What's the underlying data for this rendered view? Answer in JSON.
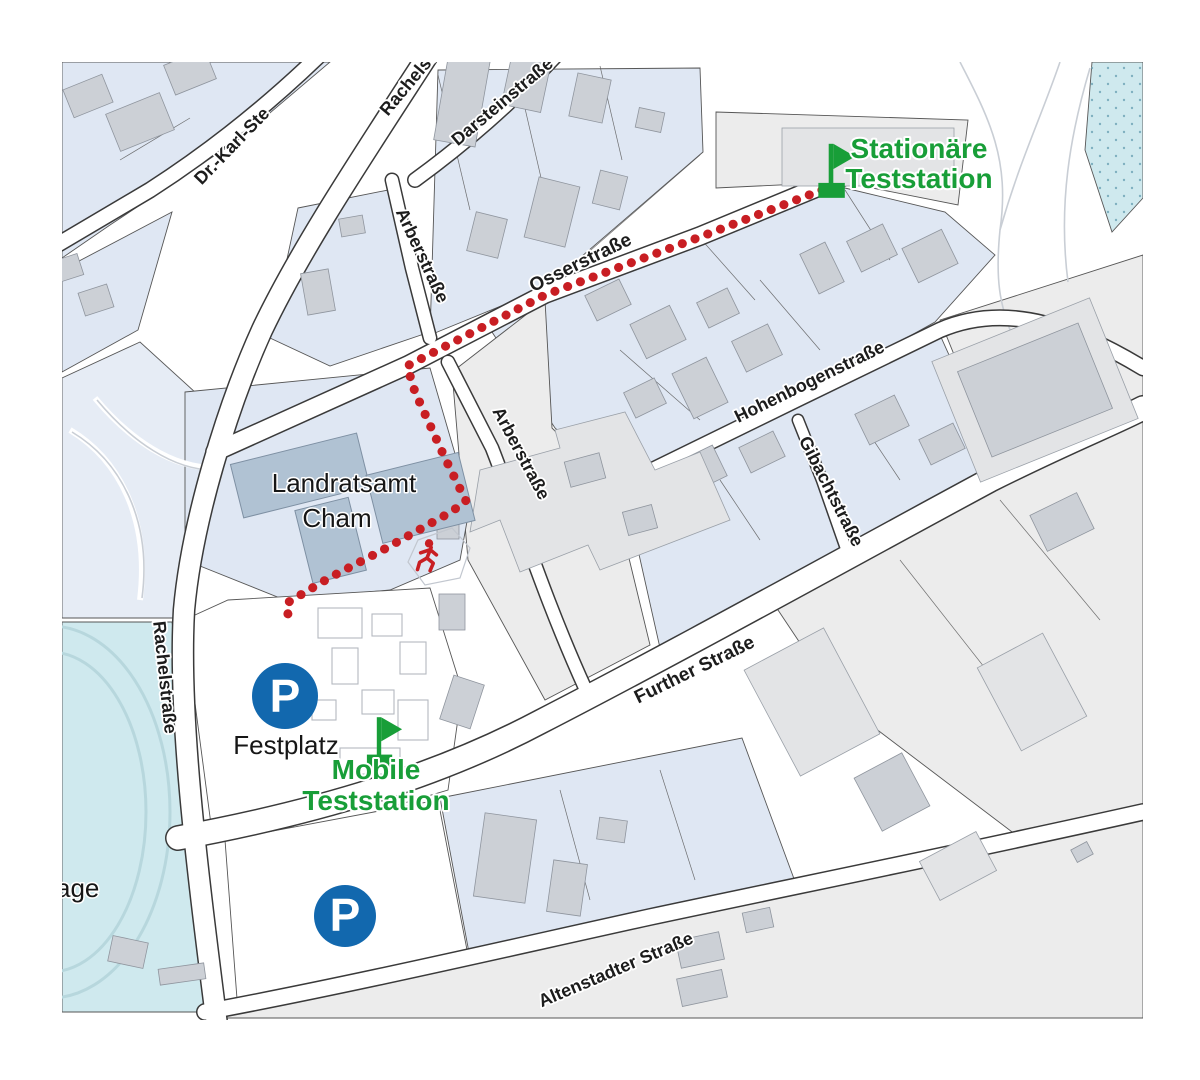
{
  "map": {
    "streets": {
      "dr_karl": "Dr.-Karl-Ste",
      "rachel_top": "Rachelst",
      "darstein": "Darsteinstraße",
      "arber_top": "Arberstraße",
      "osser": "Osserstraße",
      "hohenbogen": "Hohenbogenstraße",
      "gibacht": "Gibachtstraße",
      "arber_low": "Arberstraße",
      "rachel_left": "Rachelstraße",
      "further": "Further Straße",
      "alten": "Altenstadter Straße"
    },
    "places": {
      "landratsamt_line1": "Landratsamt",
      "landratsamt_line2": "Cham",
      "festplatz": "Festplatz",
      "partial_bottom_left": "age"
    },
    "stations": {
      "stationary_line1": "Stationäre",
      "stationary_line2": "Teststation",
      "mobile_line1": "Mobile",
      "mobile_line2": "Teststation"
    },
    "parking_letter": "P",
    "colors": {
      "station_green": "#189e38",
      "route_red": "#c81e23",
      "parking_blue": "#1268ae",
      "parcel_blue": "#dfe7f3",
      "parcel_gray": "#ececec",
      "building_gray": "#ccd0d6",
      "landratsamt_building": "#b0c2d3",
      "water_cyan": "#cfe9ee"
    }
  }
}
